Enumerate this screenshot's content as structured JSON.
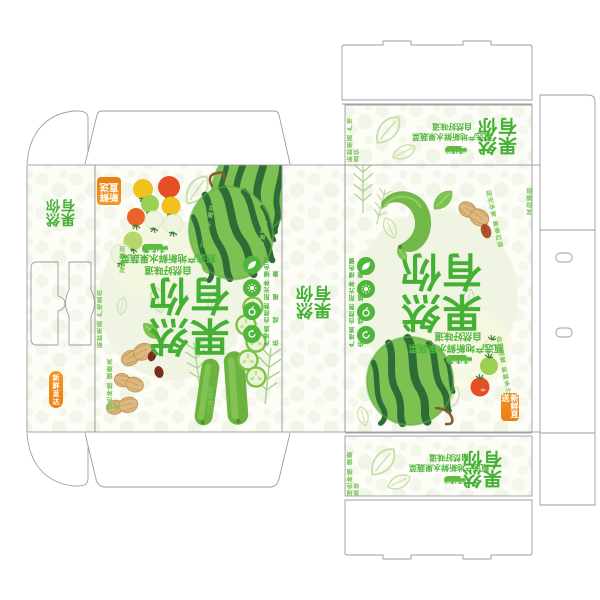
{
  "brand": {
    "title": "果然有你",
    "subtitle_main": "甄选产地新鲜水果蔬菜",
    "subtitle_sub": "自然好味道",
    "tag": "新鲜采摘"
  },
  "badges": {
    "corner": "新鲜直送",
    "side_pill": "新鲜直达"
  },
  "features": [
    {
      "icon": "leaf-icon",
      "label": "绿色健康"
    },
    {
      "icon": "sun-icon",
      "label": "阳光种植"
    },
    {
      "icon": "fruit-icon",
      "label": "自然熟成"
    },
    {
      "icon": "recycle-icon",
      "label": "产地直供"
    }
  ],
  "texts": {
    "vertical_a": "新鲜果蔬 产地直供",
    "vertical_b": "绿色种植 健康美味",
    "arc_a": "自然甜蜜 新鲜多汁",
    "arc_b": "阳光孕育 果香四溢",
    "small_a": "现摘现发",
    "small_b": "甜脆爽口"
  },
  "colors": {
    "brand_green": "#4fb53c",
    "melon_dark": "#2d6b37",
    "accent_orange": "#ef8a1c",
    "leaf_pale": "#cadfa9"
  }
}
